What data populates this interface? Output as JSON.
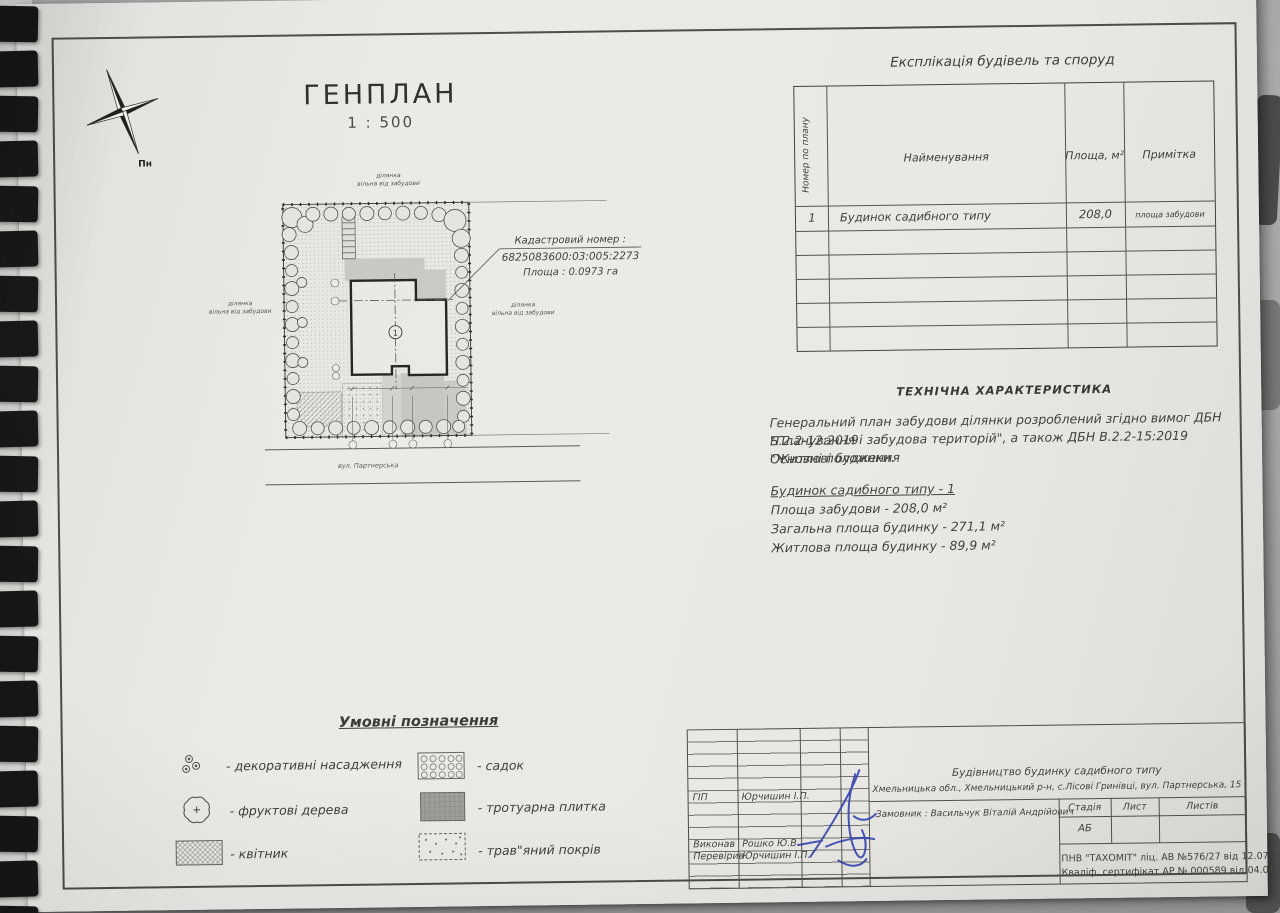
{
  "drawing": {
    "title": "ГЕНПЛАН",
    "scale": "1 : 500"
  },
  "compass": {
    "north_label": "Пн"
  },
  "site_plan": {
    "area_label_line1": "ділянка",
    "area_label_line2": "вільна від забудови",
    "street_label": "вул. Партнерська",
    "building_number": "1",
    "cadastral_line1": "Кадастровий номер :",
    "cadastral_line2": "6825083600:03:005:2273",
    "cadastral_line3": "Площа : 0.0973 га"
  },
  "explication_table": {
    "title": "Експлікація будівель та споруд",
    "col_number": "Номер по плану",
    "col_name": "Найменування",
    "col_area": "Площа, м²",
    "col_note": "Примітка",
    "row1": {
      "number": "1",
      "name": "Будинок садибного типу",
      "area": "208,0",
      "note": "площа забудови"
    },
    "empty_rows": 5
  },
  "tech": {
    "title": "ТЕХНІЧНА ХАРАКТЕРИСТИКА",
    "para_line1": "Генеральний план забудови ділянки розроблений згідно вимог ДБН Б.2.2-12:2019",
    "para_line2": "\"Планування і забудова територій\", а також ДБН В.2.2-15:2019 \"Житлові будинки.",
    "para_line3": "Основні положення",
    "house_heading": "Будинок садибного типу - 1",
    "area_line1": "Площа забудови - 208,0 м²",
    "area_line2": "Загальна площа будинку - 271,1 м²",
    "area_line3": "Житлова площа будинку - 89,9 м²"
  },
  "legend": {
    "title": "Умовні позначення",
    "item1": "- декоративні насадження",
    "item2": "- фруктові дерева",
    "item3": "- квітник",
    "item4": "- садок",
    "item5": "- тротуарна плитка",
    "item6": "- трав\"яний покрів"
  },
  "title_block": {
    "role1": "ГІП",
    "name1": "Юрчишин І.П.",
    "role2": "Виконав",
    "name2": "Рошко Ю.В.",
    "role3": "Перевірив",
    "name3": "Юрчишин І.П.",
    "project": "Будівництво будинку садибного типу",
    "address": "Хмельницька обл.,  Хмельницький р-н, с.Лісові Гринівці, вул. Партнерська, 15",
    "customer": "Замовник : Васильчук Віталій Андрійович",
    "stage_col": "Стадія",
    "sheet_col": "Лист",
    "sheets_col": "Листів",
    "stage_value": "АБ",
    "license_line1": "ПНВ \"ТАХОМІТ\" ліц. АВ №576/27 від 12.07.10р.",
    "license_line2": "Кваліф. сертифікат АР № 000589 від 04.06.2012 р."
  }
}
